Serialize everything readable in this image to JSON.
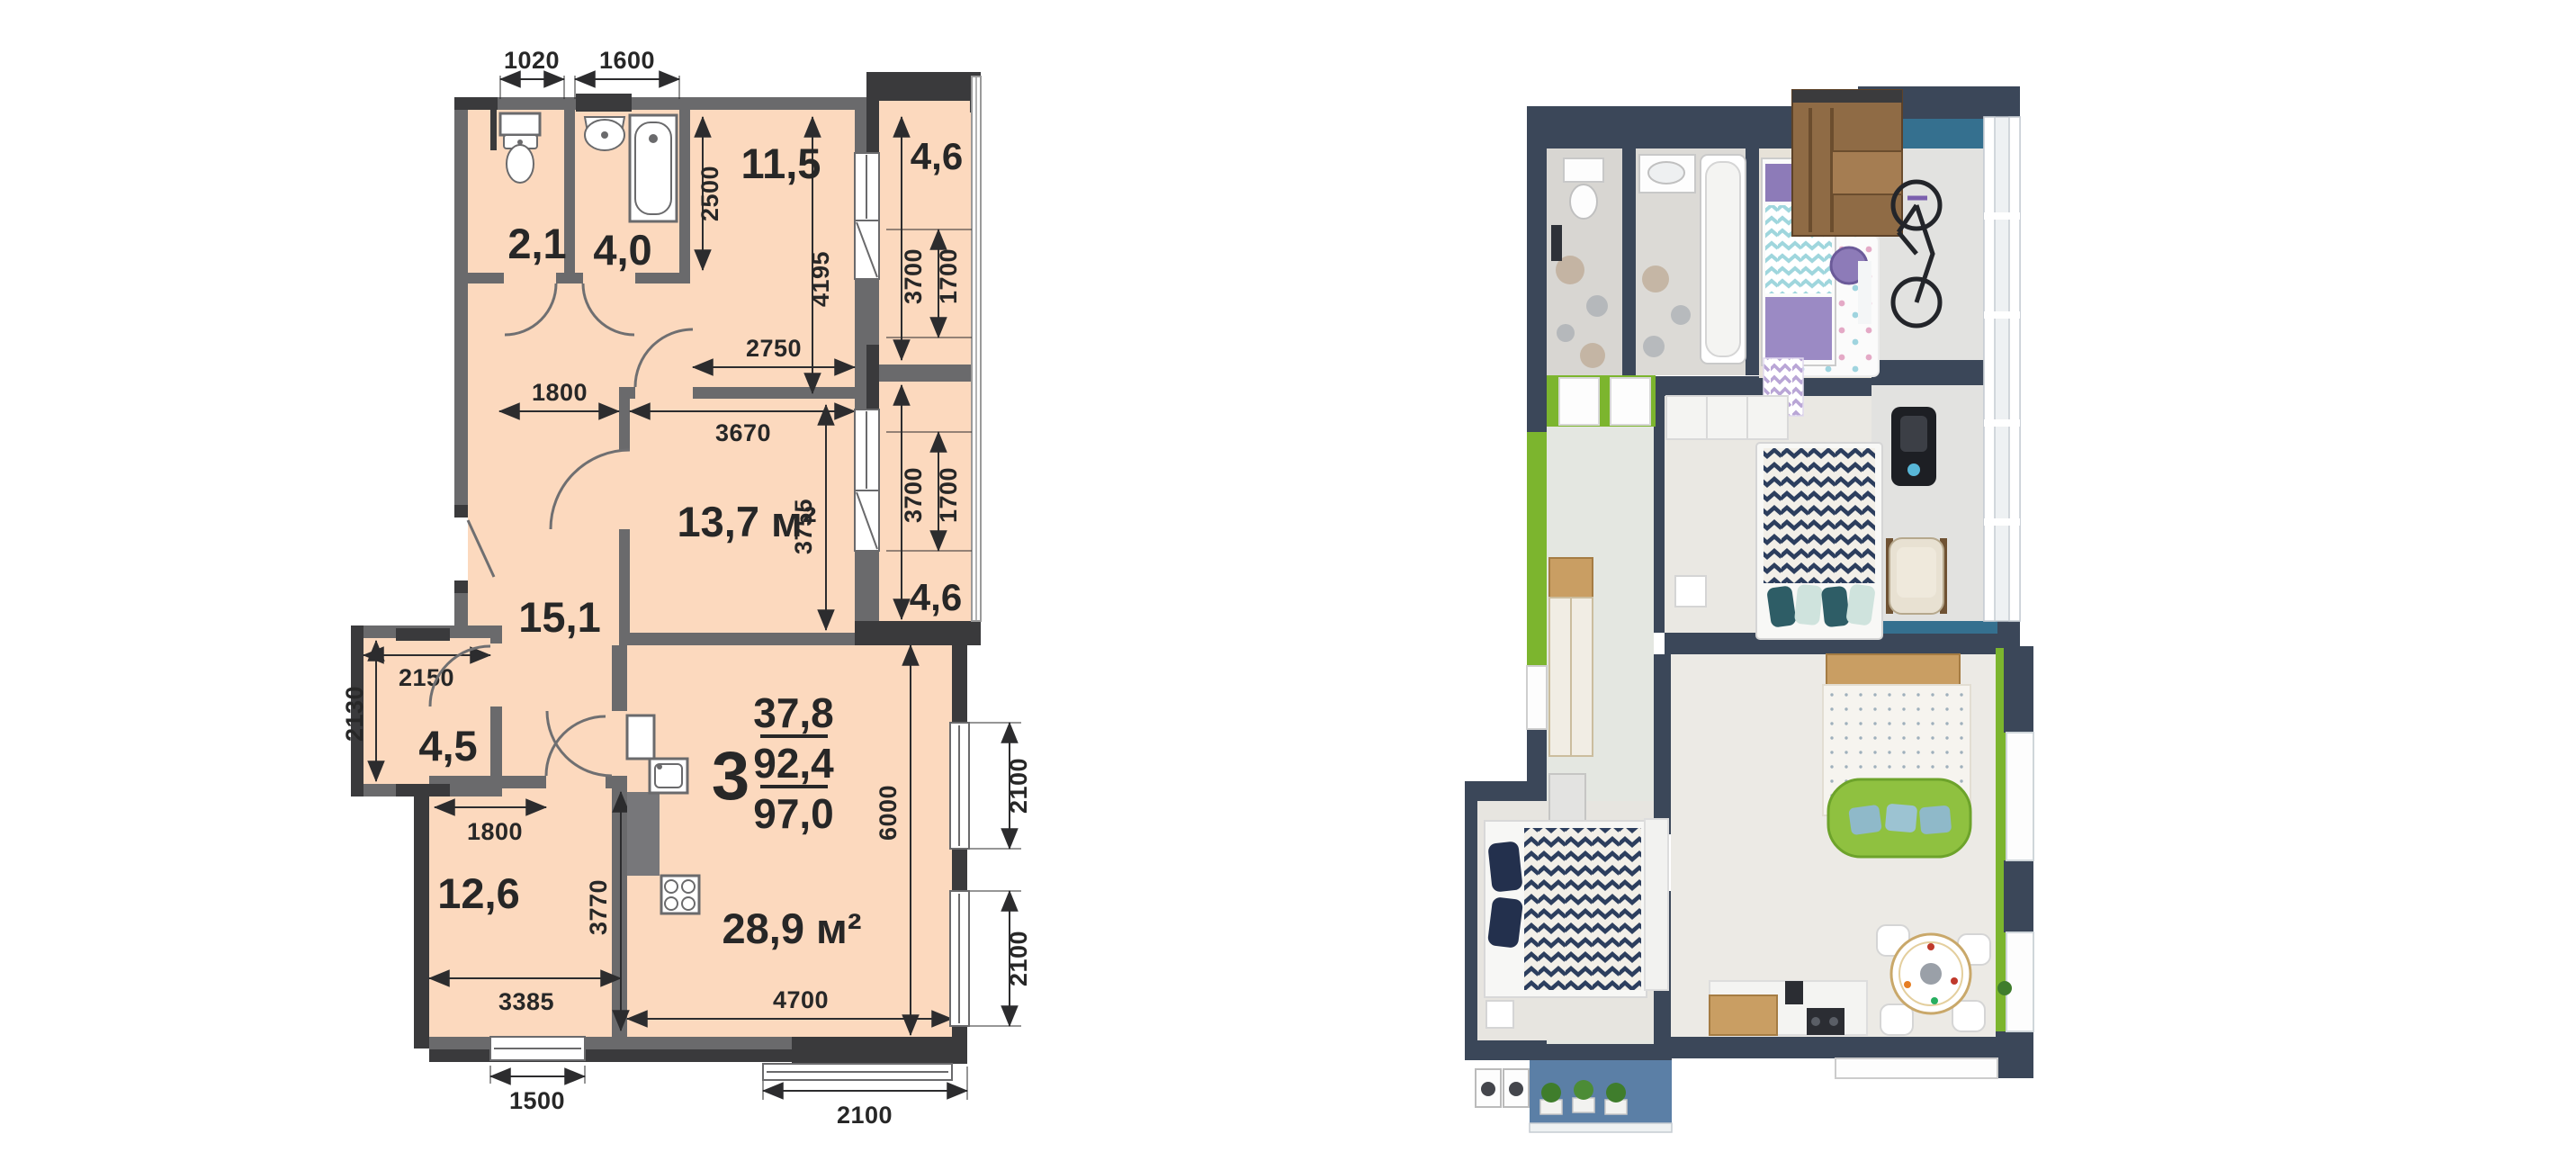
{
  "floor_plan": {
    "rooms": [
      {
        "id": "wc",
        "area": "2,1"
      },
      {
        "id": "bathroom",
        "area": "4,0"
      },
      {
        "id": "bedroom-top",
        "area": "11,5"
      },
      {
        "id": "balcony-top",
        "area": "4,6"
      },
      {
        "id": "bedroom-middle",
        "area": "13,7 м²"
      },
      {
        "id": "hallway",
        "area": "15,1"
      },
      {
        "id": "storage",
        "area": "4,5"
      },
      {
        "id": "bedroom-bottom",
        "area": "12,6"
      },
      {
        "id": "kitchen-living",
        "area": "28,9 м²"
      },
      {
        "id": "balcony-middle",
        "area": "4,6"
      }
    ],
    "summary": {
      "rooms_count": "3",
      "living_area": "37,8",
      "apartment_area": "92,4",
      "total_area": "97,0"
    },
    "dimensions": {
      "wc_width": "1020",
      "bathroom_width": "1600",
      "bedroom_top_depth": "2500",
      "bedroom_top_height": "4195",
      "bedroom_top_width": "2750",
      "balcony_top_length": "3700",
      "balcony_top_window": "1700",
      "hallway_width": "1800",
      "bedroom_middle_width": "3670",
      "bedroom_middle_height": "3755",
      "balcony_middle_length": "3700",
      "balcony_middle_window": "1700",
      "storage_width": "2150",
      "storage_height": "2130",
      "kitchen_door_width": "1800",
      "bedroom_bottom_height": "3770",
      "bedroom_bottom_width": "3385",
      "living_width": "4700",
      "living_height": "6000",
      "bedroom_bottom_window": "1500",
      "living_window_bottom": "2100",
      "living_window_right_upper": "2100",
      "living_window_right_lower": "2100"
    }
  },
  "render_palette": {
    "wall": "#3b4759",
    "accent_teal": "#35708f",
    "accent_green": "#7cb52e",
    "sofa_green": "#8fc140",
    "floor_light": "#eae8e3",
    "wood": "#c79a5f",
    "balcony_blue": "#5b7fa6"
  }
}
